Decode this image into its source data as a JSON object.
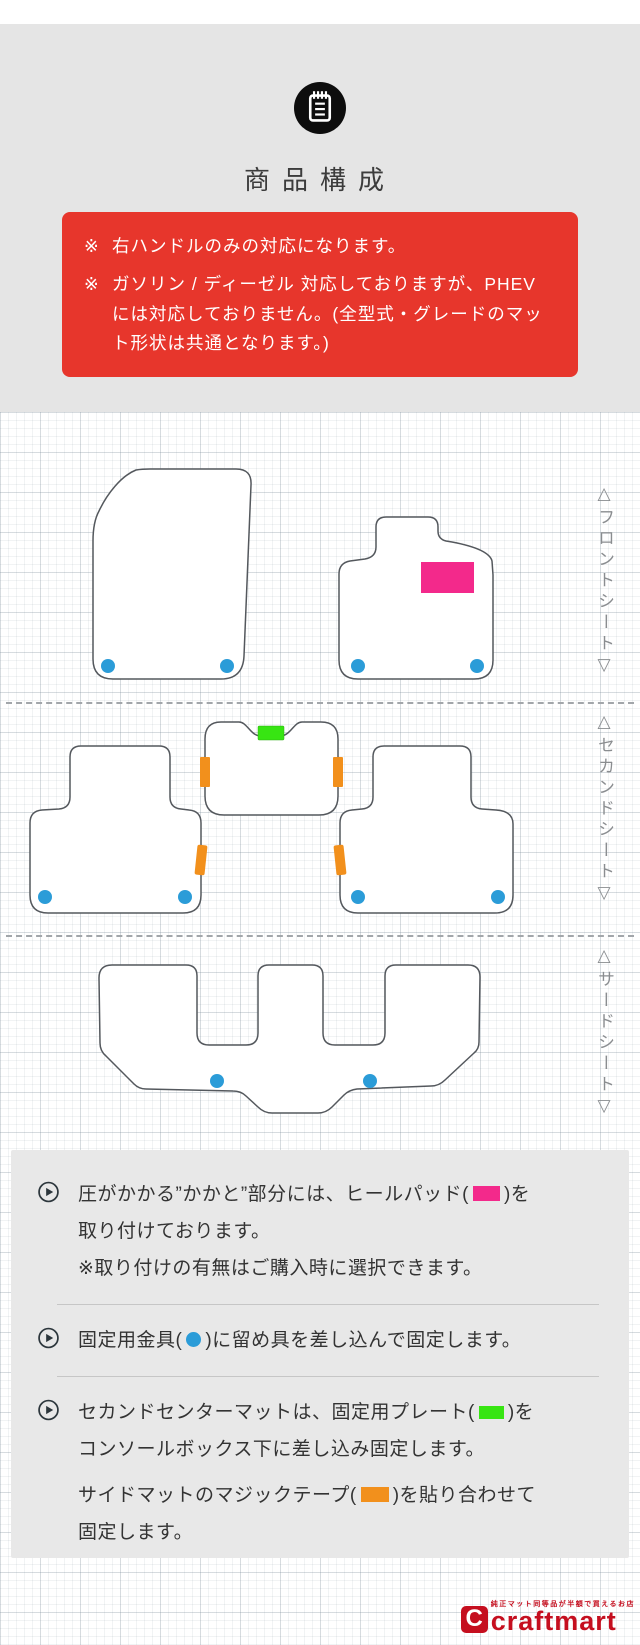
{
  "colors": {
    "gray": "#e5e5e5",
    "red": "#e7362c",
    "pink": "#f3298b",
    "blue": "#2b9cd8",
    "green": "#37e512",
    "orange": "#f2901c",
    "logored": "#c50f1f"
  },
  "header": {
    "icon": "memo-icon",
    "title": "商品構成"
  },
  "notice": {
    "items": [
      {
        "marker": "※",
        "text": "右ハンドルのみの対応になります。"
      },
      {
        "marker": "※",
        "text": "ガソリン / ディーゼル 対応しておりますが、PHEV には対応しておりません。(全型式・グレードのマット形状は共通となります。)"
      }
    ]
  },
  "diagram": {
    "sections": [
      {
        "id": "front",
        "label": "△フロントシート▽"
      },
      {
        "id": "second",
        "label": "△セカンドシート▽"
      },
      {
        "id": "third",
        "label": "△サードシート▽"
      }
    ],
    "markers": {
      "heel_pad": "#f3298b",
      "fixing_hardware": "#2b9cd8",
      "fixing_plate": "#37e512",
      "magic_tape": "#f2901c"
    }
  },
  "legend": {
    "item1": {
      "before": "圧がかかる”かかと”部分には、ヒールパッド(",
      "after": ")を",
      "line2": "取り付けております。",
      "note": "※取り付けの有無はご購入時に選択できます。"
    },
    "item2": {
      "before": "固定用金具(",
      "after": ")に留め具を差し込んで固定します。"
    },
    "item3": {
      "p1_before": "セカンドセンターマットは、固定用プレート(",
      "p1_after": ")を",
      "p1_line2": "コンソールボックス下に差し込み固定します。",
      "p2_before": "サイドマットのマジックテープ(",
      "p2_after": ")を貼り合わせて",
      "p2_line2": "固定します。"
    }
  },
  "footer_logo": {
    "tagline": "純正マット同等品が半額で買えるお店",
    "brand": "craftmart",
    "initial": "C"
  }
}
